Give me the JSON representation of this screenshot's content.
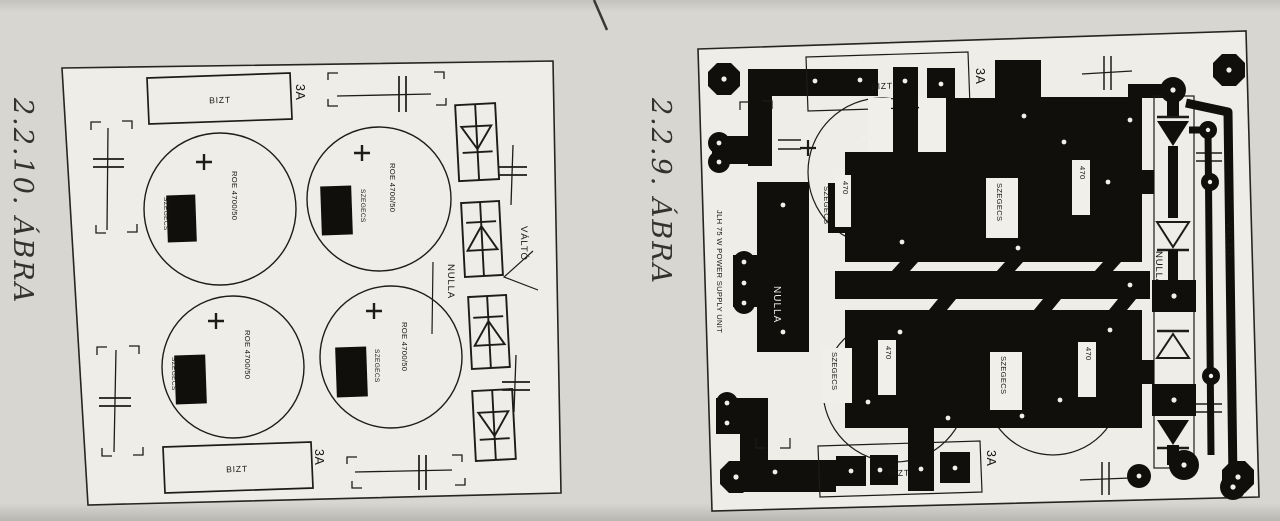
{
  "page": {
    "paper_color": "#d8d6d1",
    "board_fill": "#efede8",
    "ink_color": "#1d1c19"
  },
  "figure_left": {
    "caption": "2.2.10. ÁBRA",
    "labels": {
      "fuse": "BIZT",
      "fuse_rating": "3A",
      "capacitor_value": "ROE 4700/50",
      "rivet": "SZEGECS",
      "ac_live": "VÁLTÓ",
      "neutral": "NULLA"
    }
  },
  "figure_right": {
    "caption": "2.2.9. ÁBRA",
    "board_title": "JLH 75 W POWER SUPPLY UNIT",
    "labels": {
      "fuse": "BIZT",
      "fuse_rating": "3A",
      "rivet": "SZEGECS",
      "ac_live": "VÁLTÓ",
      "neutral": "NULLA",
      "capacitor_value_fragment": "470"
    }
  }
}
